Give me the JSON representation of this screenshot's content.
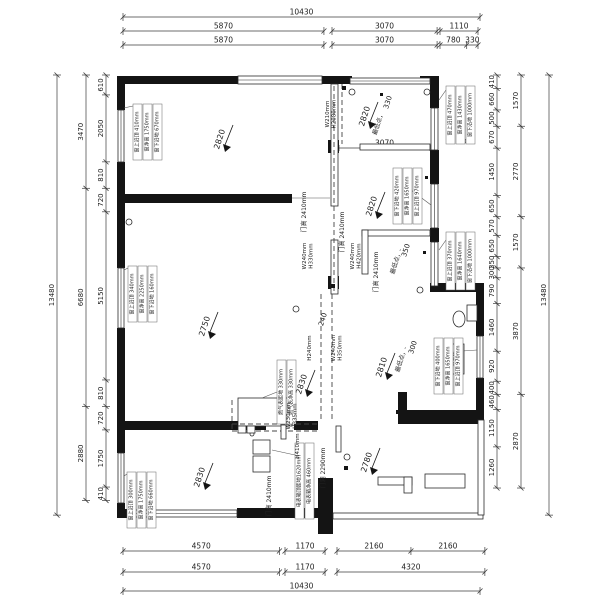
{
  "meta": {
    "canvas": {
      "w": 600,
      "h": 600
    },
    "colors": {
      "ink": "#141414",
      "dim": "#3c3c3c",
      "thin": "#2a2a2a",
      "beam_text": "#3b3bcf",
      "bg": "#ffffff"
    },
    "scales": {
      "h": 0.03423,
      "v": 0.03265
    }
  },
  "dim_chains": [
    {
      "dir": "h",
      "y": 17,
      "x": 123,
      "mm": [
        10430
      ]
    },
    {
      "dir": "h",
      "y": 31,
      "x": 123,
      "mm": [
        5870
      ]
    },
    {
      "dir": "h",
      "y": 31,
      "x": 332,
      "mm": [
        3070
      ]
    },
    {
      "dir": "h",
      "y": 31,
      "x": 440,
      "mm": [
        1110
      ]
    },
    {
      "dir": "h",
      "y": 45,
      "x": 123,
      "mm": [
        5870
      ]
    },
    {
      "dir": "h",
      "y": 45,
      "x": 332,
      "mm": [
        3070
      ]
    },
    {
      "dir": "h",
      "y": 45,
      "x": 440,
      "mm": [
        780,
        330
      ]
    },
    {
      "dir": "h",
      "y": 551,
      "x": 123,
      "mm": [
        4570
      ]
    },
    {
      "dir": "h",
      "y": 551,
      "x": 285,
      "mm": [
        1170
      ]
    },
    {
      "dir": "h",
      "y": 551,
      "x": 337,
      "mm": [
        2160,
        2160
      ]
    },
    {
      "dir": "h",
      "y": 572,
      "x": 123,
      "mm": [
        4570
      ]
    },
    {
      "dir": "h",
      "y": 572,
      "x": 285,
      "mm": [
        1170
      ]
    },
    {
      "dir": "h",
      "y": 572,
      "x": 337,
      "mm": [
        4320
      ]
    },
    {
      "dir": "h",
      "y": 591,
      "x": 123,
      "mm": [
        10430
      ]
    },
    {
      "dir": "v",
      "x": 57,
      "y": 75,
      "mm": [
        13480
      ]
    },
    {
      "dir": "v",
      "x": 86,
      "y": 75,
      "mm": [
        3470,
        6680,
        2880
      ]
    },
    {
      "dir": "v",
      "x": 106,
      "y": 75,
      "mm": [
        610,
        2050,
        810,
        720,
        5150,
        810,
        720,
        1750,
        410
      ]
    },
    {
      "dir": "v",
      "x": 497,
      "y": 75,
      "mm": [
        410,
        660,
        500,
        670,
        1450,
        650,
        570,
        650,
        350,
        300,
        790,
        1460,
        920,
        400,
        460,
        1150,
        1260
      ]
    },
    {
      "dir": "v",
      "x": 521,
      "y": 75,
      "mm": [
        1570,
        2770,
        1570,
        3870,
        2870
      ]
    },
    {
      "dir": "v",
      "x": 549,
      "y": 75,
      "mm": [
        13480
      ]
    }
  ],
  "interior_dims": [
    {
      "x1": 339,
      "x2": 430,
      "y": 148,
      "label": "3070"
    }
  ],
  "walls": [
    [
      120,
      76,
      120,
      8
    ],
    [
      318,
      76,
      34,
      8
    ],
    [
      420,
      76,
      19,
      8
    ],
    [
      430,
      76,
      9,
      32
    ],
    [
      117,
      76,
      8,
      34
    ],
    [
      117,
      162,
      8,
      106
    ],
    [
      117,
      328,
      8,
      125
    ],
    [
      117,
      503,
      8,
      15
    ],
    [
      117,
      509,
      16,
      9
    ],
    [
      237,
      508,
      96,
      10
    ],
    [
      124,
      194,
      168,
      9
    ],
    [
      430,
      150,
      9,
      34
    ],
    [
      430,
      228,
      9,
      14
    ],
    [
      430,
      283,
      54,
      9
    ],
    [
      476,
      292,
      8,
      44
    ],
    [
      476,
      378,
      8,
      34
    ],
    [
      398,
      410,
      86,
      14
    ],
    [
      398,
      392,
      9,
      20
    ],
    [
      318,
      478,
      15,
      56
    ],
    [
      124,
      421,
      142,
      9
    ],
    [
      294,
      421,
      24,
      9
    ],
    [
      328,
      140,
      11,
      13
    ],
    [
      328,
      276,
      11,
      13
    ]
  ],
  "thin_walls": [
    [
      331,
      84,
      7,
      122
    ],
    [
      331,
      240,
      7,
      54
    ],
    [
      360,
      144,
      70,
      6
    ],
    [
      362,
      230,
      68,
      6
    ],
    [
      362,
      230,
      6,
      44
    ],
    [
      333,
      513,
      150,
      6
    ],
    [
      478,
      420,
      6,
      95
    ],
    [
      238,
      398,
      54,
      28
    ]
  ],
  "windows": [
    [
      238,
      76,
      84,
      8
    ],
    [
      350,
      78,
      80,
      6
    ],
    [
      118,
      110,
      6,
      52
    ],
    [
      118,
      268,
      6,
      60
    ],
    [
      118,
      453,
      6,
      50
    ],
    [
      431,
      108,
      7,
      42
    ],
    [
      431,
      184,
      7,
      44
    ],
    [
      431,
      242,
      7,
      44
    ],
    [
      477,
      336,
      6,
      42
    ],
    [
      131,
      510,
      106,
      7
    ]
  ],
  "dashed": [
    [
      321,
      294,
      321,
      422
    ],
    [
      332,
      294,
      332,
      422
    ],
    [
      334,
      86,
      334,
      294
    ],
    [
      342,
      84,
      342,
      144
    ],
    [
      232,
      424,
      318,
      424
    ],
    [
      232,
      431,
      318,
      431
    ],
    [
      232,
      400,
      232,
      431
    ]
  ],
  "thin_lines": [
    [
      292,
      198,
      330,
      198
    ],
    [
      124,
      108,
      133,
      106
    ],
    [
      124,
      270,
      128,
      268
    ],
    [
      124,
      476,
      127,
      474
    ],
    [
      439,
      100,
      446,
      90
    ],
    [
      439,
      250,
      446,
      240
    ],
    [
      411,
      190,
      431,
      205
    ],
    [
      448,
      352,
      477,
      350
    ],
    [
      295,
      455,
      272,
      450
    ],
    [
      277,
      392,
      262,
      398
    ]
  ],
  "door_leaves": [
    [
      281,
      425,
      5,
      14
    ],
    [
      336,
      426,
      5,
      26
    ]
  ],
  "circles": [
    [
      352,
      92,
      3
    ],
    [
      427,
      92,
      3
    ],
    [
      129,
      222,
      3
    ],
    [
      296,
      309,
      3
    ],
    [
      347,
      457,
      3
    ],
    [
      420,
      290,
      3
    ],
    [
      464,
      141,
      2
    ],
    [
      252,
      434,
      2
    ]
  ],
  "squares": [
    [
      342,
      86,
      4
    ],
    [
      331,
      284,
      4
    ],
    [
      344,
      466,
      4
    ],
    [
      396,
      410,
      4
    ],
    [
      423,
      251,
      3
    ],
    [
      380,
      93,
      3
    ],
    [
      425,
      176,
      3
    ]
  ],
  "fixtures": {
    "toilet": {
      "tank": [
        467,
        305,
        10,
        16
      ],
      "bowl": [
        459,
        313,
        6,
        8
      ]
    },
    "weak_box": {
      "rect": [
        451,
        344,
        13,
        30
      ],
      "label": "弱电箱"
    },
    "counters": [
      [
        378,
        477,
        34,
        8
      ],
      [
        404,
        477,
        8,
        16
      ],
      [
        425,
        474,
        40,
        14
      ]
    ],
    "meters": [
      [
        253,
        440,
        17,
        14
      ],
      [
        253,
        456,
        17,
        16
      ],
      [
        238,
        426,
        8,
        7
      ],
      [
        247,
        426,
        8,
        7
      ]
    ]
  },
  "window_strips": [
    {
      "name": "window-anno-left-top",
      "x": 133,
      "y": 104,
      "h": 56,
      "lines": [
        "窗上沿顶 410mm",
        "窗净高 1750mm",
        "窗下沿地 670mm"
      ]
    },
    {
      "name": "window-anno-left-mid",
      "x": 128,
      "y": 266,
      "h": 56,
      "lines": [
        "窗上沿顶 340mm",
        "窗净高 2250mm",
        "窗下沿地 160mm"
      ]
    },
    {
      "name": "window-anno-left-bottom",
      "x": 127,
      "y": 472,
      "h": 56,
      "lines": [
        "窗上沿顶 300mm",
        "窗净高 1750mm",
        "窗下沿地 660mm"
      ]
    },
    {
      "name": "window-anno-right-top",
      "x": 446,
      "y": 86,
      "h": 58,
      "lines": [
        "窗上沿顶 470mm",
        "窗净高 1430mm",
        "窗下沿地 1000mm"
      ]
    },
    {
      "name": "window-anno-right-room",
      "x": 393,
      "y": 168,
      "h": 56,
      "lines": [
        "窗下沿地 420mm",
        "窗净高 1650mm",
        "窗上沿顶 970mm"
      ]
    },
    {
      "name": "window-anno-right-mid",
      "x": 446,
      "y": 232,
      "h": 58,
      "lines": [
        "窗上沿顶 370mm",
        "窗净高 1640mm",
        "窗下沿地 1000mm"
      ]
    },
    {
      "name": "window-anno-right-bottom",
      "x": 434,
      "y": 338,
      "h": 56,
      "lines": [
        "窗下沿地 400mm",
        "窗净高 1650mm",
        "窗上沿顶 970mm"
      ]
    },
    {
      "name": "meter-anno",
      "x": 295,
      "y": 443,
      "h": 76,
      "lines": [
        "电表箱顶距地1620mm",
        "电表箱净高 460mm"
      ]
    },
    {
      "name": "gas-anno",
      "x": 277,
      "y": 360,
      "h": 64,
      "lines": [
        "燃气表距地 330mm",
        "燃气表净高 330mm"
      ]
    }
  ],
  "blue_annos": [
    {
      "x": 329,
      "y": 96,
      "lines": [
        "W210mm",
        "H2080mm"
      ]
    },
    {
      "x": 306,
      "y": 238,
      "lines": [
        "W240mm",
        "H330mm"
      ]
    },
    {
      "x": 354,
      "y": 238,
      "lines": [
        "W240mm",
        "H420mm"
      ]
    },
    {
      "x": 311,
      "y": 330,
      "lines": [
        "H240mm"
      ]
    },
    {
      "x": 335,
      "y": 330,
      "lines": [
        "W240mm",
        "H350mm"
      ]
    },
    {
      "x": 290,
      "y": 398,
      "lines": [
        "W230mm",
        "H335mm"
      ]
    },
    {
      "x": 299,
      "y": 428,
      "lines": [
        "H410mm"
      ]
    }
  ],
  "vertical_labels": [
    {
      "x": 306,
      "y": 212,
      "t": "门高 2410mm"
    },
    {
      "x": 344,
      "y": 232,
      "t": "门高 2410mm"
    },
    {
      "x": 378,
      "y": 272,
      "t": "门高 2410mm"
    },
    {
      "x": 271,
      "y": 496,
      "t": "门高 2410mm"
    },
    {
      "x": 325,
      "y": 468,
      "t": "门洞 2290mm"
    }
  ],
  "room_labels": [
    {
      "t": "2820",
      "x": 222,
      "y": 140,
      "arrow": true
    },
    {
      "t": "2820",
      "x": 367,
      "y": 117,
      "arrow": true
    },
    {
      "t": "330",
      "x": 390,
      "y": 103,
      "fs": 7
    },
    {
      "t": "最低点，",
      "x": 380,
      "y": 124,
      "fs": 6
    },
    {
      "t": "2820",
      "x": 374,
      "y": 207,
      "arrow": true
    },
    {
      "t": "350",
      "x": 408,
      "y": 251,
      "fs": 7
    },
    {
      "t": "最低点，-",
      "x": 398,
      "y": 262,
      "fs": 6
    },
    {
      "t": "2750",
      "x": 207,
      "y": 327,
      "arrow": true
    },
    {
      "t": "2830",
      "x": 304,
      "y": 385,
      "arrow": true
    },
    {
      "t": "2810",
      "x": 384,
      "y": 368,
      "arrow": true
    },
    {
      "t": "300",
      "x": 415,
      "y": 348,
      "fs": 7
    },
    {
      "t": "最低点，-",
      "x": 403,
      "y": 360,
      "fs": 6
    },
    {
      "t": "2780",
      "x": 369,
      "y": 463,
      "arrow": true
    },
    {
      "t": "2830",
      "x": 202,
      "y": 478,
      "arrow": true
    },
    {
      "t": "240",
      "x": 325,
      "y": 320,
      "fs": 7
    }
  ]
}
